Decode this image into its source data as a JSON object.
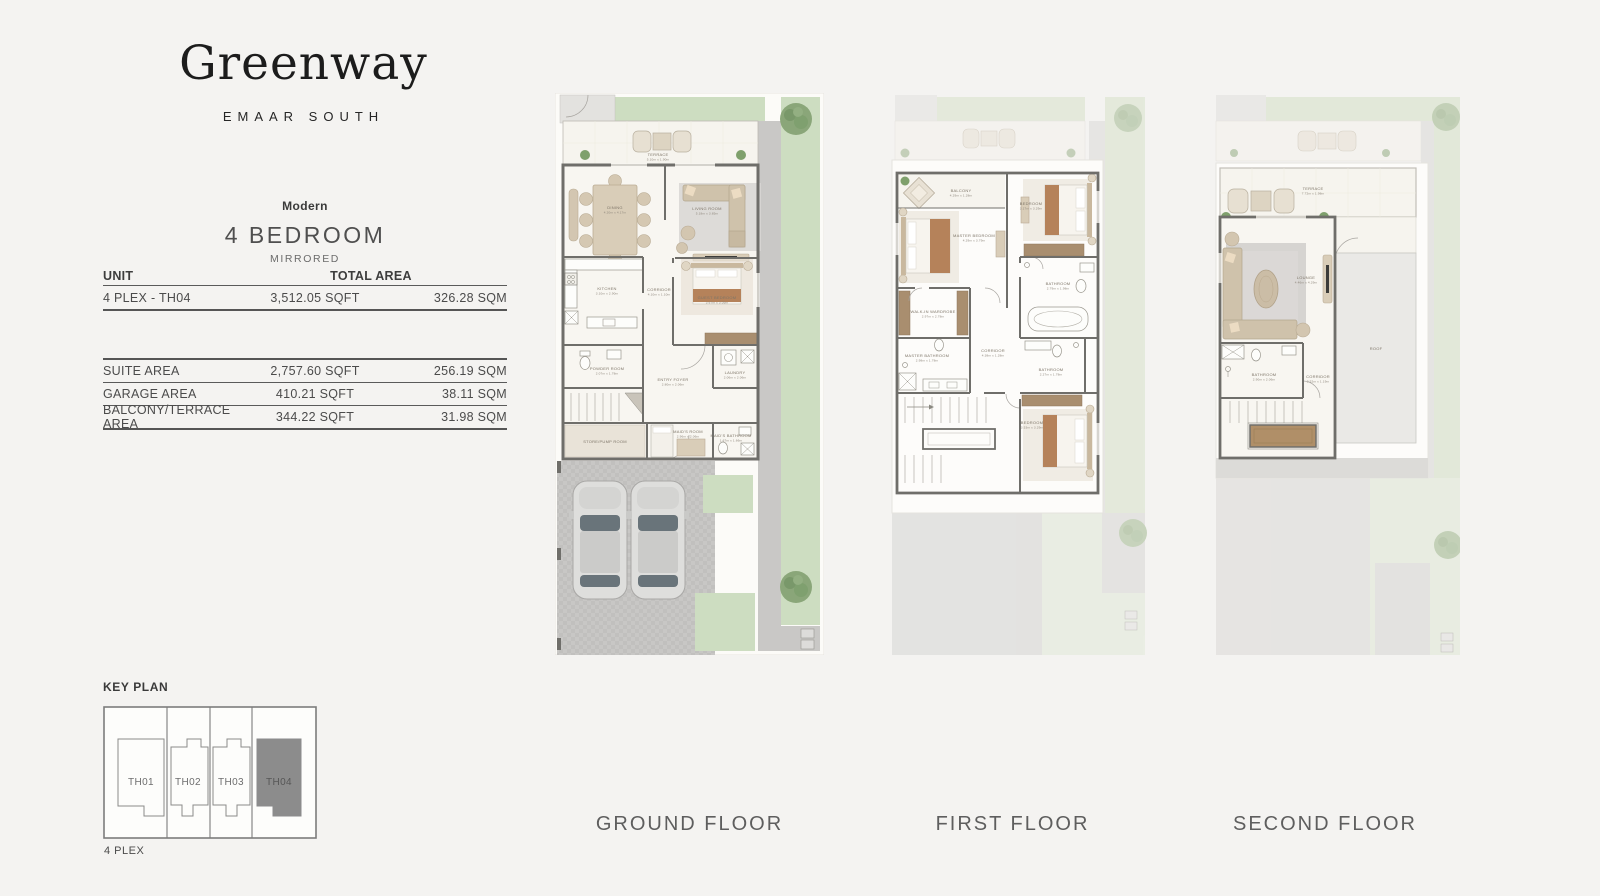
{
  "brand": {
    "name": "Greenway",
    "tagline": "EMAAR SOUTH"
  },
  "unit": {
    "collection": "Modern",
    "title": "4 BEDROOM",
    "variant": "MIRRORED"
  },
  "area_table": {
    "col_unit": "UNIT",
    "col_total": "TOTAL AREA",
    "unit_row": {
      "label": "4 PLEX - TH04",
      "sqft": "3,512.05 SQFT",
      "sqm": "326.28 SQM"
    },
    "rows": [
      {
        "label": "SUITE AREA",
        "sqft": "2,757.60 SQFT",
        "sqm": "256.19 SQM"
      },
      {
        "label": "GARAGE AREA",
        "sqft": "410.21 SQFT",
        "sqm": "38.11 SQM"
      },
      {
        "label": "BALCONY/TERRACE AREA",
        "sqft": "344.22 SQFT",
        "sqm": "31.98 SQM"
      }
    ]
  },
  "key_plan": {
    "title": "KEY PLAN",
    "caption": "4 PLEX",
    "highlighted_unit": "TH04",
    "units": [
      {
        "label": "TH01"
      },
      {
        "label": "TH02"
      },
      {
        "label": "TH03"
      },
      {
        "label": "TH04"
      }
    ]
  },
  "floors": [
    {
      "name": "GROUND FLOOR",
      "rooms": [
        {
          "label": "TERRACE",
          "dims": "5.10m x 1.90m"
        },
        {
          "label": "DINING",
          "dims": "4.20m x 4.17m"
        },
        {
          "label": "LIVING ROOM",
          "dims": "5.18m x 3.85m"
        },
        {
          "label": "KITCHEN",
          "dims": "3.10m x 2.90m"
        },
        {
          "label": "CORRIDOR",
          "dims": "4.10m x 1.10m"
        },
        {
          "label": "GUEST BEDROOM",
          "dims": "3.67m x 3.05m"
        },
        {
          "label": "POWDER ROOM",
          "dims": "2.07m x 1.78m"
        },
        {
          "label": "LAUNDRY",
          "dims": "2.06m x 2.06m"
        },
        {
          "label": "ENTRY FOYER",
          "dims": "2.80m x 2.06m"
        },
        {
          "label": "STORE/PUMP ROOM",
          "dims": ""
        },
        {
          "label": "MAID'S ROOM",
          "dims": "2.96m x 2.06m"
        },
        {
          "label": "MAID'S BATHROOM",
          "dims": "1.67m x 1.66m"
        }
      ]
    },
    {
      "name": "FIRST FLOOR",
      "rooms": [
        {
          "label": "BALCONY",
          "dims": "4.29m x 1.28m"
        },
        {
          "label": "MASTER BEDROOM",
          "dims": "4.29m x 3.79m"
        },
        {
          "label": "BEDROOM",
          "dims": "3.17m x 3.29m"
        },
        {
          "label": "BATHROOM",
          "dims": "2.79m x 1.98m"
        },
        {
          "label": "WALK-IN WARDROBE",
          "dims": "2.97m x 2.78m"
        },
        {
          "label": "MASTER BATHROOM",
          "dims": "2.98m x 1.78m"
        },
        {
          "label": "CORRIDOR",
          "dims": "4.38m x 1.28m"
        },
        {
          "label": "BATHROOM",
          "dims": "2.27m x 1.78m"
        },
        {
          "label": "BEDROOM",
          "dims": "3.53m x 3.29m"
        }
      ]
    },
    {
      "name": "SECOND FLOOR",
      "rooms": [
        {
          "label": "TERRACE",
          "dims": "7.72m x 1.98m"
        },
        {
          "label": "LOUNGE",
          "dims": "4.46m x 4.29m"
        },
        {
          "label": "BATHROOM",
          "dims": "2.90m x 2.06m"
        },
        {
          "label": "CORRIDOR",
          "dims": "2.52m x 1.19m"
        },
        {
          "label": "ROOF",
          "dims": ""
        }
      ]
    }
  ],
  "palette": {
    "background": "#f4f3f1",
    "lawn": "#cdddc1",
    "paving": "#c9c8c6",
    "wall": "#6f6e6a",
    "floor": "#f8f6f1",
    "wood_wardrobe": "#a98e6f",
    "furniture_beige": "#d9cdb8",
    "bed_throw": "#b5825a",
    "keyplan_highlight": "#8c8c8c"
  }
}
